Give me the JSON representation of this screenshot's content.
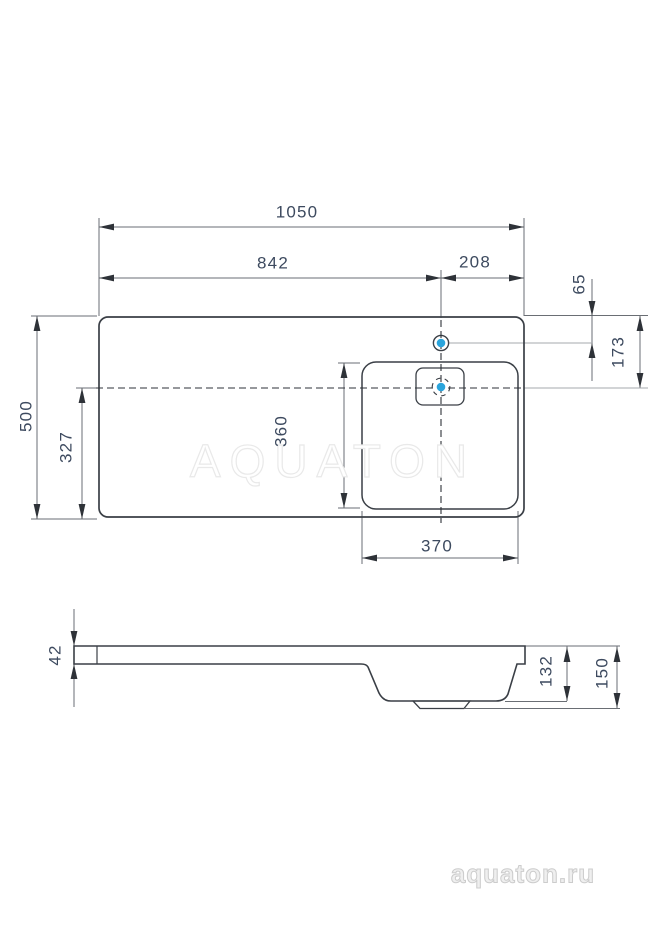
{
  "dimensions": {
    "overall_width": "1050",
    "left_edge_to_faucet": "842",
    "faucet_to_right_edge": "208",
    "top_edge_to_faucet": "65",
    "top_edge_to_drain": "173",
    "overall_depth": "500",
    "drain_to_front_edge": "327",
    "bowl_depth": "360",
    "bowl_width": "370",
    "countertop_thickness": "42",
    "basin_height": "132",
    "total_height": "150"
  },
  "watermark": "AQUATON",
  "brand_logo": "aquaton.ru",
  "colors": {
    "accent-blue": "#2aa4dc",
    "line-dark": "#3a3f46",
    "dim-line": "#6a6e74",
    "dim-text": "#3d4a5f",
    "ref-gray": "#a6aaae",
    "watermark-gray": "#e9e9e9",
    "logo-gray": "#cccccc"
  }
}
